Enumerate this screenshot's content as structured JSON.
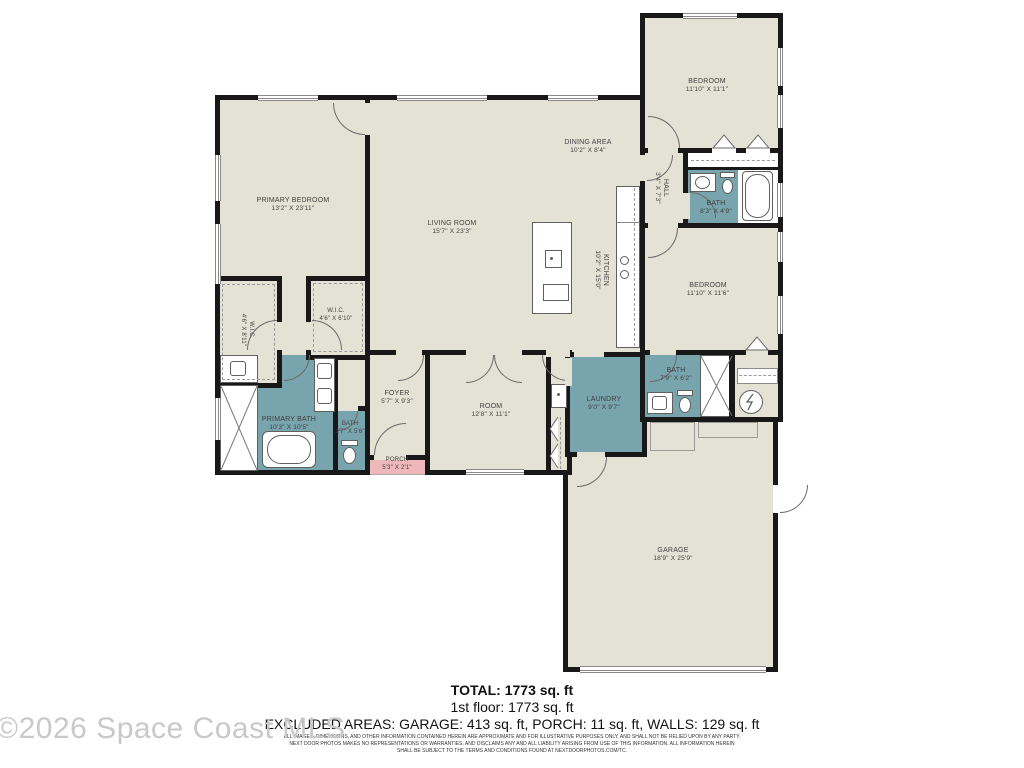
{
  "colors": {
    "wall": "#181818",
    "floor": "#e4e2d5",
    "wet_room": "#78a4ae",
    "porch": "#eeb8ba",
    "label_text": "#3f3f3f",
    "watermark": "#c9c9c9"
  },
  "rooms": [
    {
      "id": "primary-bedroom",
      "name": "PRIMARY BEDROOM",
      "dims": "13'2\" X 23'11\""
    },
    {
      "id": "living-room",
      "name": "LIVING ROOM",
      "dims": "15'7\" X 23'3\""
    },
    {
      "id": "dining-area",
      "name": "DINING AREA",
      "dims": "10'2\" X 8'4\""
    },
    {
      "id": "kitchen",
      "name": "KITCHEN",
      "dims": "10'2\" X 15'0\""
    },
    {
      "id": "bedroom-top",
      "name": "BEDROOM",
      "dims": "11'10\" X 11'1\""
    },
    {
      "id": "hall",
      "name": "HALL",
      "dims": "3'4\" X 7'3\""
    },
    {
      "id": "bath-hall",
      "name": "BATH",
      "dims": "8'3\" X 4'9\""
    },
    {
      "id": "bedroom-right",
      "name": "BEDROOM",
      "dims": "11'10\" X 11'6\""
    },
    {
      "id": "bath-rear",
      "name": "BATH",
      "dims": "7'9\" X 6'2\""
    },
    {
      "id": "laundry",
      "name": "LAUNDRY",
      "dims": "9'0\" X 9'7\""
    },
    {
      "id": "room",
      "name": "ROOM",
      "dims": "12'8\" X 11'1\""
    },
    {
      "id": "foyer",
      "name": "FOYER",
      "dims": "5'7\" X 9'3\""
    },
    {
      "id": "primary-bath",
      "name": "PRIMARY BATH",
      "dims": "10'3\" X 10'5\""
    },
    {
      "id": "bath-small",
      "name": "BATH",
      "dims": "2'7\" X 5'6\""
    },
    {
      "id": "wic-right",
      "name": "W.I.C.",
      "dims": "4'6\" X 6'10\""
    },
    {
      "id": "wic-left",
      "name": "W.I.C.",
      "dims": "4'6\" X 8'11\""
    },
    {
      "id": "porch",
      "name": "PORCH",
      "dims": "5'3\" X 2'1\""
    },
    {
      "id": "garage",
      "name": "GARAGE",
      "dims": "18'9\" X 25'9\""
    }
  ],
  "symbols": [
    "door-swing-arc",
    "window",
    "shower-x-stall",
    "bathtub",
    "toilet",
    "sink-vanity",
    "stove-burners",
    "kitchen-island-sink",
    "water-heater-bolt",
    "bifold-closet-chevron",
    "garage-door",
    "closet-shelf-dashed"
  ],
  "footer": {
    "total": "TOTAL: 1773 sq. ft",
    "first_floor": "1st floor: 1773 sq. ft",
    "excluded": "EXCLUDED AREAS: GARAGE: 413 sq. ft, PORCH: 11 sq. ft, WALLS: 129 sq. ft",
    "disclaimer_1": "ALL IMAGES, DIMENSIONS, AND OTHER INFORMATION CONTAINED HEREIN ARE APPROXIMATE AND FOR ILLUSTRATIVE PURPOSES ONLY, AND SHALL NOT BE RELIED UPON BY ANY PARTY.",
    "disclaimer_2": "NEXT DOOR PHOTOS MAKES NO REPRESENTATIONS OR WARRANTIES, AND DISCLAIMS ANY AND ALL LIABILITY ARISING FROM USE OF THIS INFORMATION. ALL INFORMATION HEREIN",
    "disclaimer_3": "SHALL BE SUBJECT TO THE TERMS AND CONDITIONS FOUND AT NEXTDOORPHOTOS.COM/TC."
  },
  "watermark": "©2026 Space Coast MLS"
}
